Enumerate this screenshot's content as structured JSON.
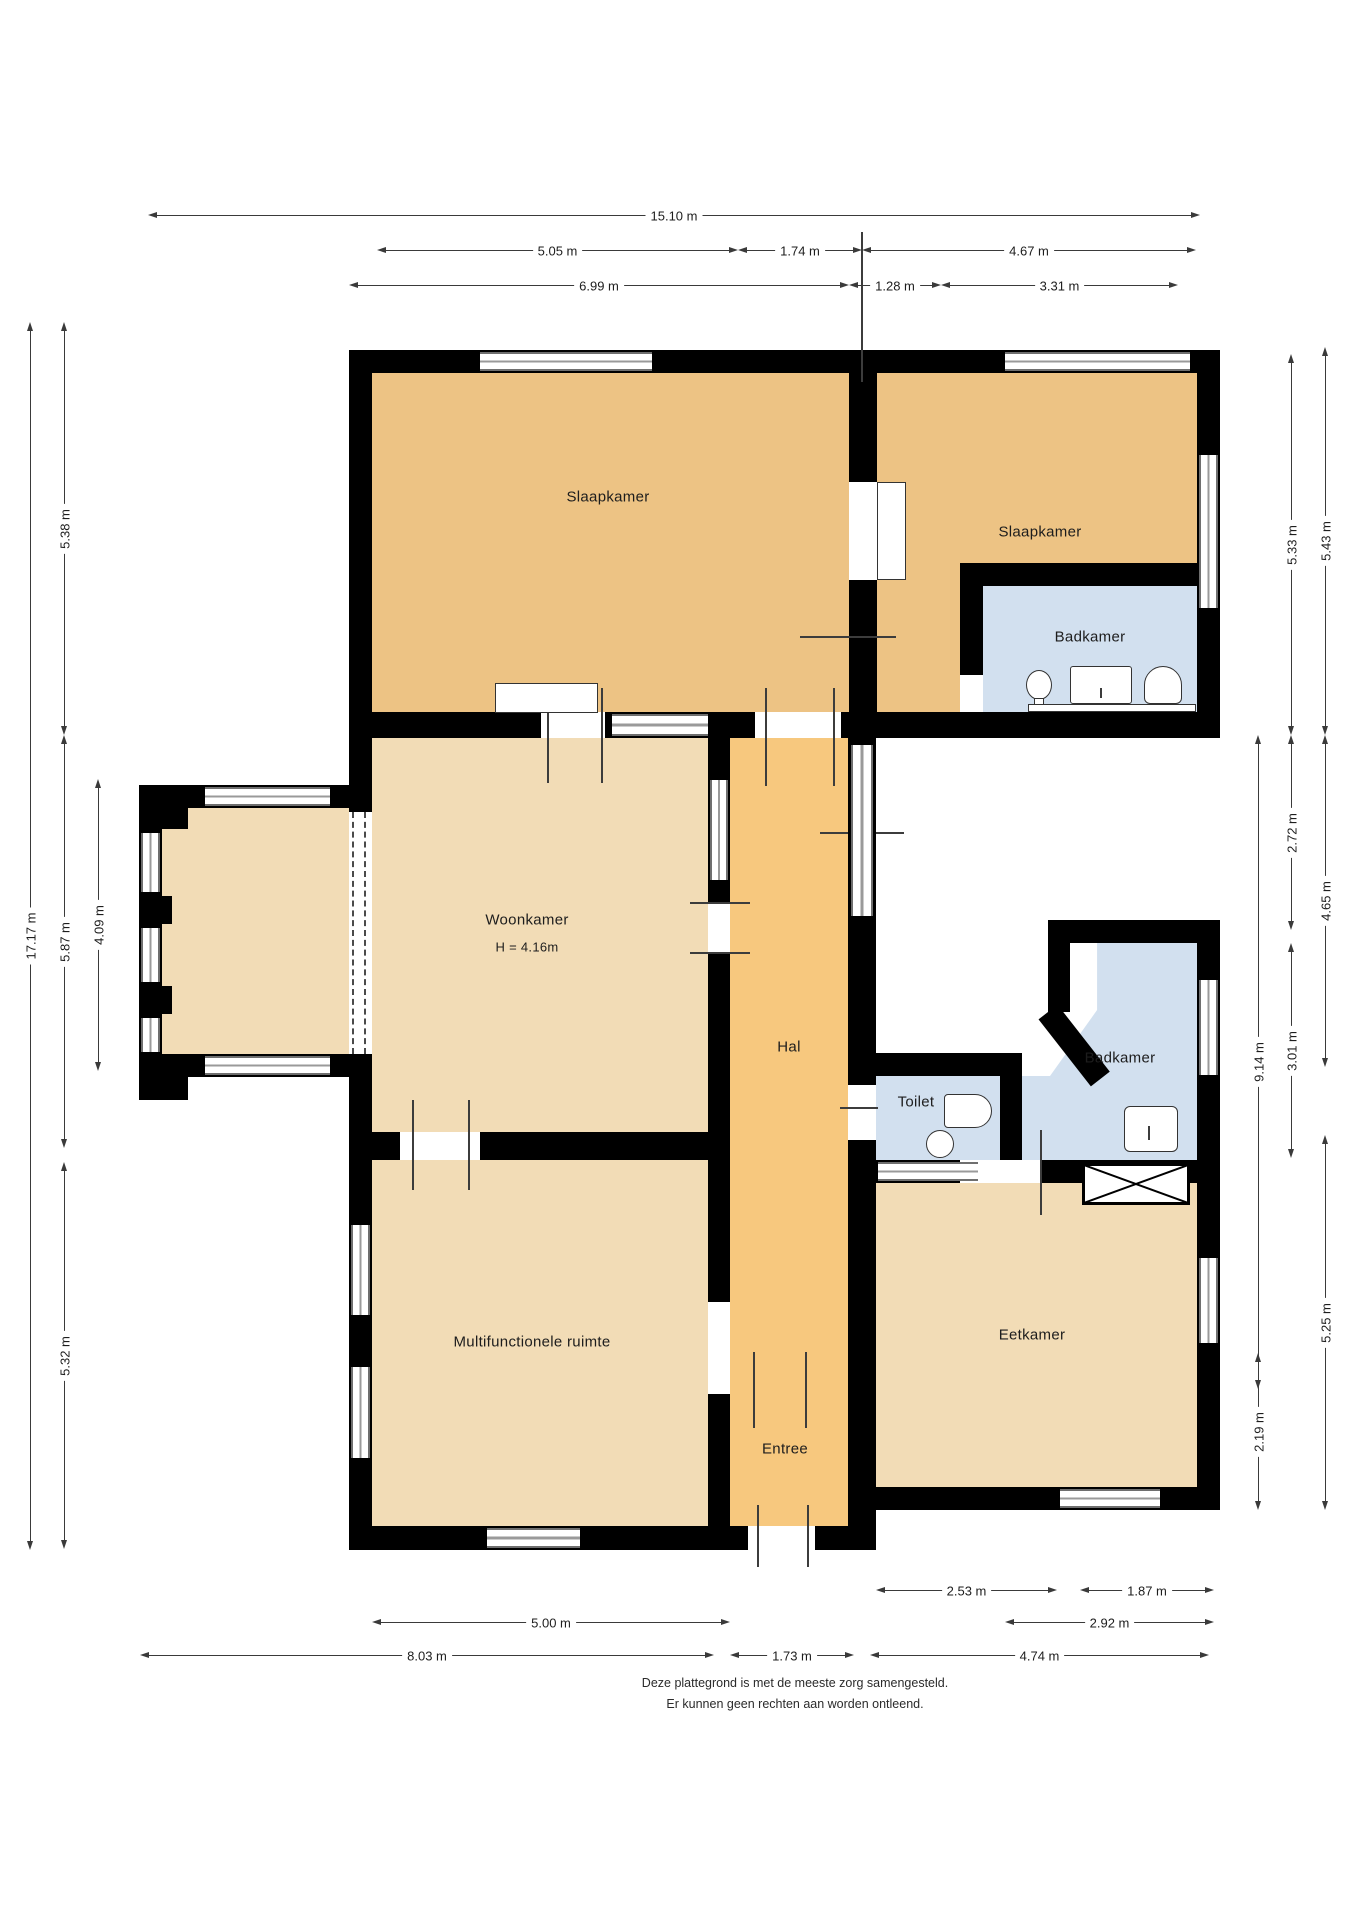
{
  "title": "Plattegrond begane grond",
  "palette": {
    "bedroom_tan": "#edc384",
    "living_tan": "#f2dcb6",
    "hall_orange": "#f7c87e",
    "bath_blue": "#d2e0ef",
    "wall": "#000000",
    "window_gray": "#8a8a8a"
  },
  "rooms": [
    {
      "id": "slaapkamer-links",
      "label": "Slaapkamer"
    },
    {
      "id": "slaapkamer-rechts",
      "label": "Slaapkamer"
    },
    {
      "id": "badkamer-boven",
      "label": "Badkamer"
    },
    {
      "id": "woonkamer",
      "label": "Woonkamer",
      "sublabel": "H = 4.16m"
    },
    {
      "id": "hal",
      "label": "Hal"
    },
    {
      "id": "toilet",
      "label": "Toilet"
    },
    {
      "id": "badkamer-midden",
      "label": "Badkamer"
    },
    {
      "id": "multifunctionele-ruimte",
      "label": "Multifunctionele ruimte"
    },
    {
      "id": "eetkamer",
      "label": "Eetkamer"
    },
    {
      "id": "entree",
      "label": "Entree"
    }
  ],
  "dims": {
    "top": [
      "15.10 m",
      "5.05 m",
      "1.74 m",
      "4.67 m",
      "6.99 m",
      "1.28 m",
      "3.31 m"
    ],
    "left": [
      "17.17 m",
      "5.38 m",
      "5.87 m",
      "5.32 m",
      "4.09 m"
    ],
    "right": [
      "9.14 m",
      "5.33 m",
      "2.72 m",
      "3.01 m",
      "2.19 m",
      "5.43 m",
      "4.65 m",
      "5.25 m"
    ],
    "bottom": [
      "2.53 m",
      "1.87 m",
      "5.00 m",
      "2.92 m",
      "8.03 m",
      "1.73 m",
      "4.74 m"
    ]
  },
  "footer": {
    "line1": "Deze plattegrond is met de meeste zorg samengesteld.",
    "line2": "Er kunnen geen rechten aan worden ontleend."
  }
}
